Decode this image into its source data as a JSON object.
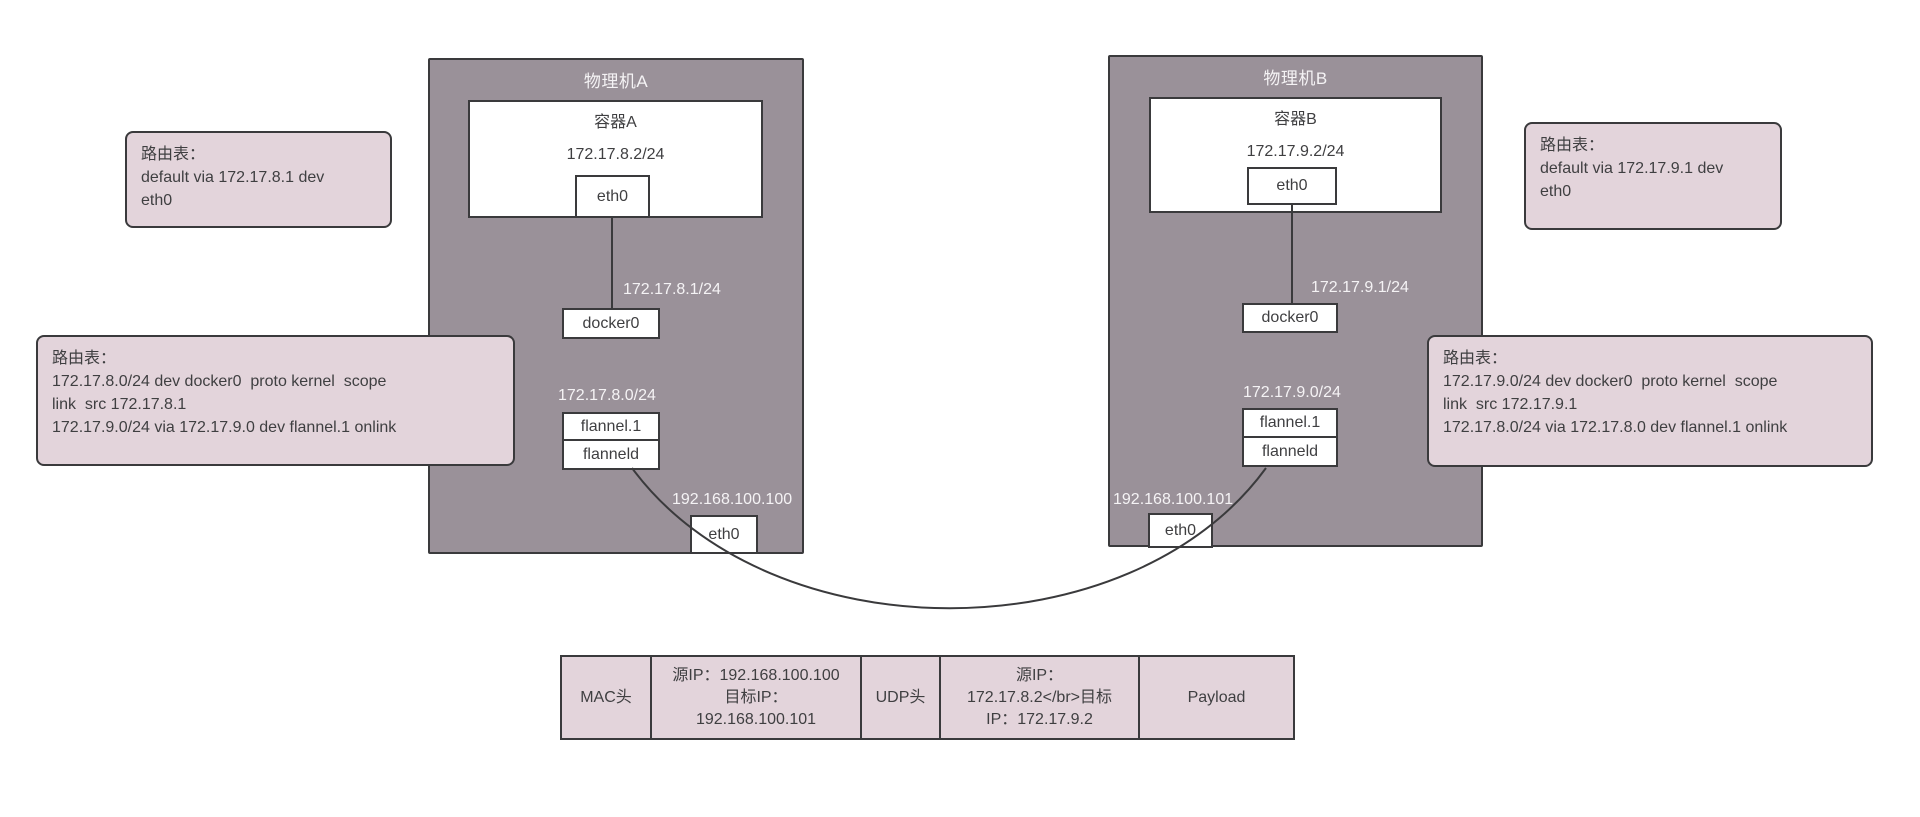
{
  "colors": {
    "machine_fill": "#9a9199",
    "panel_fill": "#e3d4db",
    "line": "#3a3a3c",
    "text_dark": "#3f3f41",
    "text_light": "#f5f3f5"
  },
  "machines": [
    {
      "title": "物理机A",
      "container": {
        "title": "容器A",
        "ip": "172.17.8.2/24",
        "eth_label": "eth0"
      },
      "docker0_label": "docker0",
      "docker0_ip": "172.17.8.1/24",
      "flannel1_label": "flannel.1",
      "flanneld_label": "flanneld",
      "flannel_subnet": "172.17.8.0/24",
      "host_eth_label": "eth0",
      "host_ip": "192.168.100.100"
    },
    {
      "title": "物理机B",
      "container": {
        "title": "容器B",
        "ip": "172.17.9.2/24",
        "eth_label": "eth0"
      },
      "docker0_label": "docker0",
      "docker0_ip": "172.17.9.1/24",
      "flannel1_label": "flannel.1",
      "flanneld_label": "flanneld",
      "flannel_subnet": "172.17.9.0/24",
      "host_eth_label": "eth0",
      "host_ip": "192.168.100.101"
    }
  ],
  "route_tables": [
    {
      "text": "路由表：\ndefault via 172.17.8.1 dev\neth0"
    },
    {
      "text": "路由表：\n172.17.8.0/24 dev docker0  proto kernel  scope\nlink  src 172.17.8.1\n172.17.9.0/24 via 172.17.9.0 dev flannel.1 onlink"
    },
    {
      "text": "路由表：\ndefault via 172.17.9.1 dev\neth0"
    },
    {
      "text": "路由表：\n172.17.9.0/24 dev docker0  proto kernel  scope\nlink  src 172.17.9.1\n172.17.8.0/24 via 172.17.8.0 dev flannel.1 onlink"
    }
  ],
  "packet": {
    "cells": [
      {
        "text": "MAC头"
      },
      {
        "text": "源IP：192.168.100.100\n目标IP：\n192.168.100.101"
      },
      {
        "text": "UDP头"
      },
      {
        "text": "源IP：\n172.17.8.2</br>目标\nIP：172.17.9.2"
      },
      {
        "text": "Payload"
      }
    ]
  }
}
